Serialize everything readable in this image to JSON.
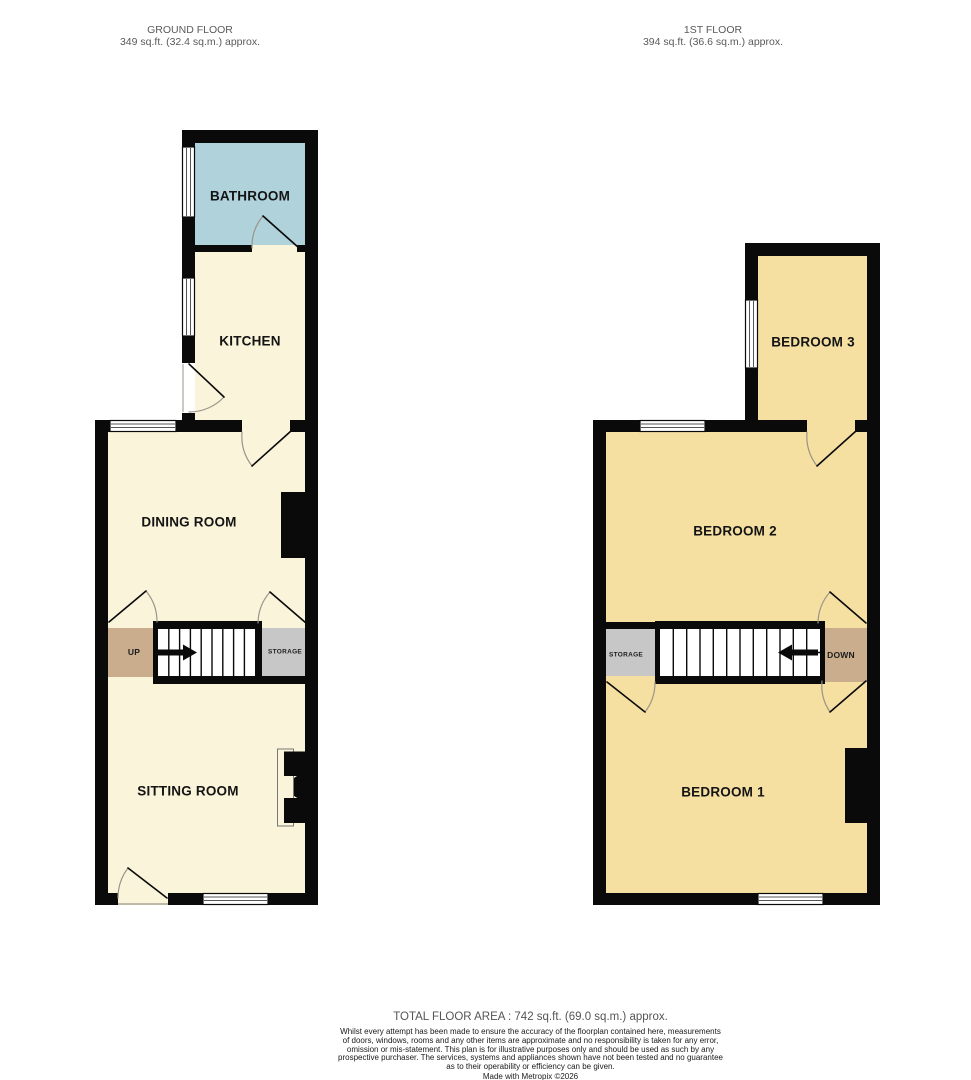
{
  "ground_floor": {
    "title": "GROUND FLOOR",
    "area": "349 sq.ft. (32.4 sq.m.) approx.",
    "rooms": {
      "bathroom": "BATHROOM",
      "kitchen": "KITCHEN",
      "dining": "DINING ROOM",
      "sitting": "SITTING ROOM",
      "storage": "STORAGE",
      "up": "UP"
    }
  },
  "first_floor": {
    "title": "1ST FLOOR",
    "area": "394 sq.ft. (36.6 sq.m.) approx.",
    "rooms": {
      "bedroom3": "BEDROOM 3",
      "bedroom2": "BEDROOM 2",
      "bedroom1": "BEDROOM 1",
      "storage": "STORAGE",
      "down": "DOWN"
    }
  },
  "footer": {
    "total_area": "TOTAL FLOOR AREA : 742 sq.ft. (69.0 sq.m.) approx.",
    "disclaimer": "Whilst every attempt has been made to ensure the accuracy of the floorplan contained here, measurements of doors, windows, rooms and any other items are approximate and no responsibility is taken for any error, omission or mis-statement. This plan is for illustrative purposes only and should be used as such by any prospective purchaser. The services, systems and appliances shown have not been tested and no guarantee as to their operability or efficiency can be given.",
    "credit": "Made with Metropix ©2026"
  },
  "colors": {
    "wall": "#0a0a0a",
    "ground_room": "#faf4da",
    "bathroom": "#afd2db",
    "first_room": "#f5e0a2",
    "landing": "#c9ad8d",
    "storage": "#c7c7c7",
    "window": "#ffffff",
    "door_arc": "#9a9588",
    "label": "#141414",
    "muted_text": "#5a5a5a"
  }
}
